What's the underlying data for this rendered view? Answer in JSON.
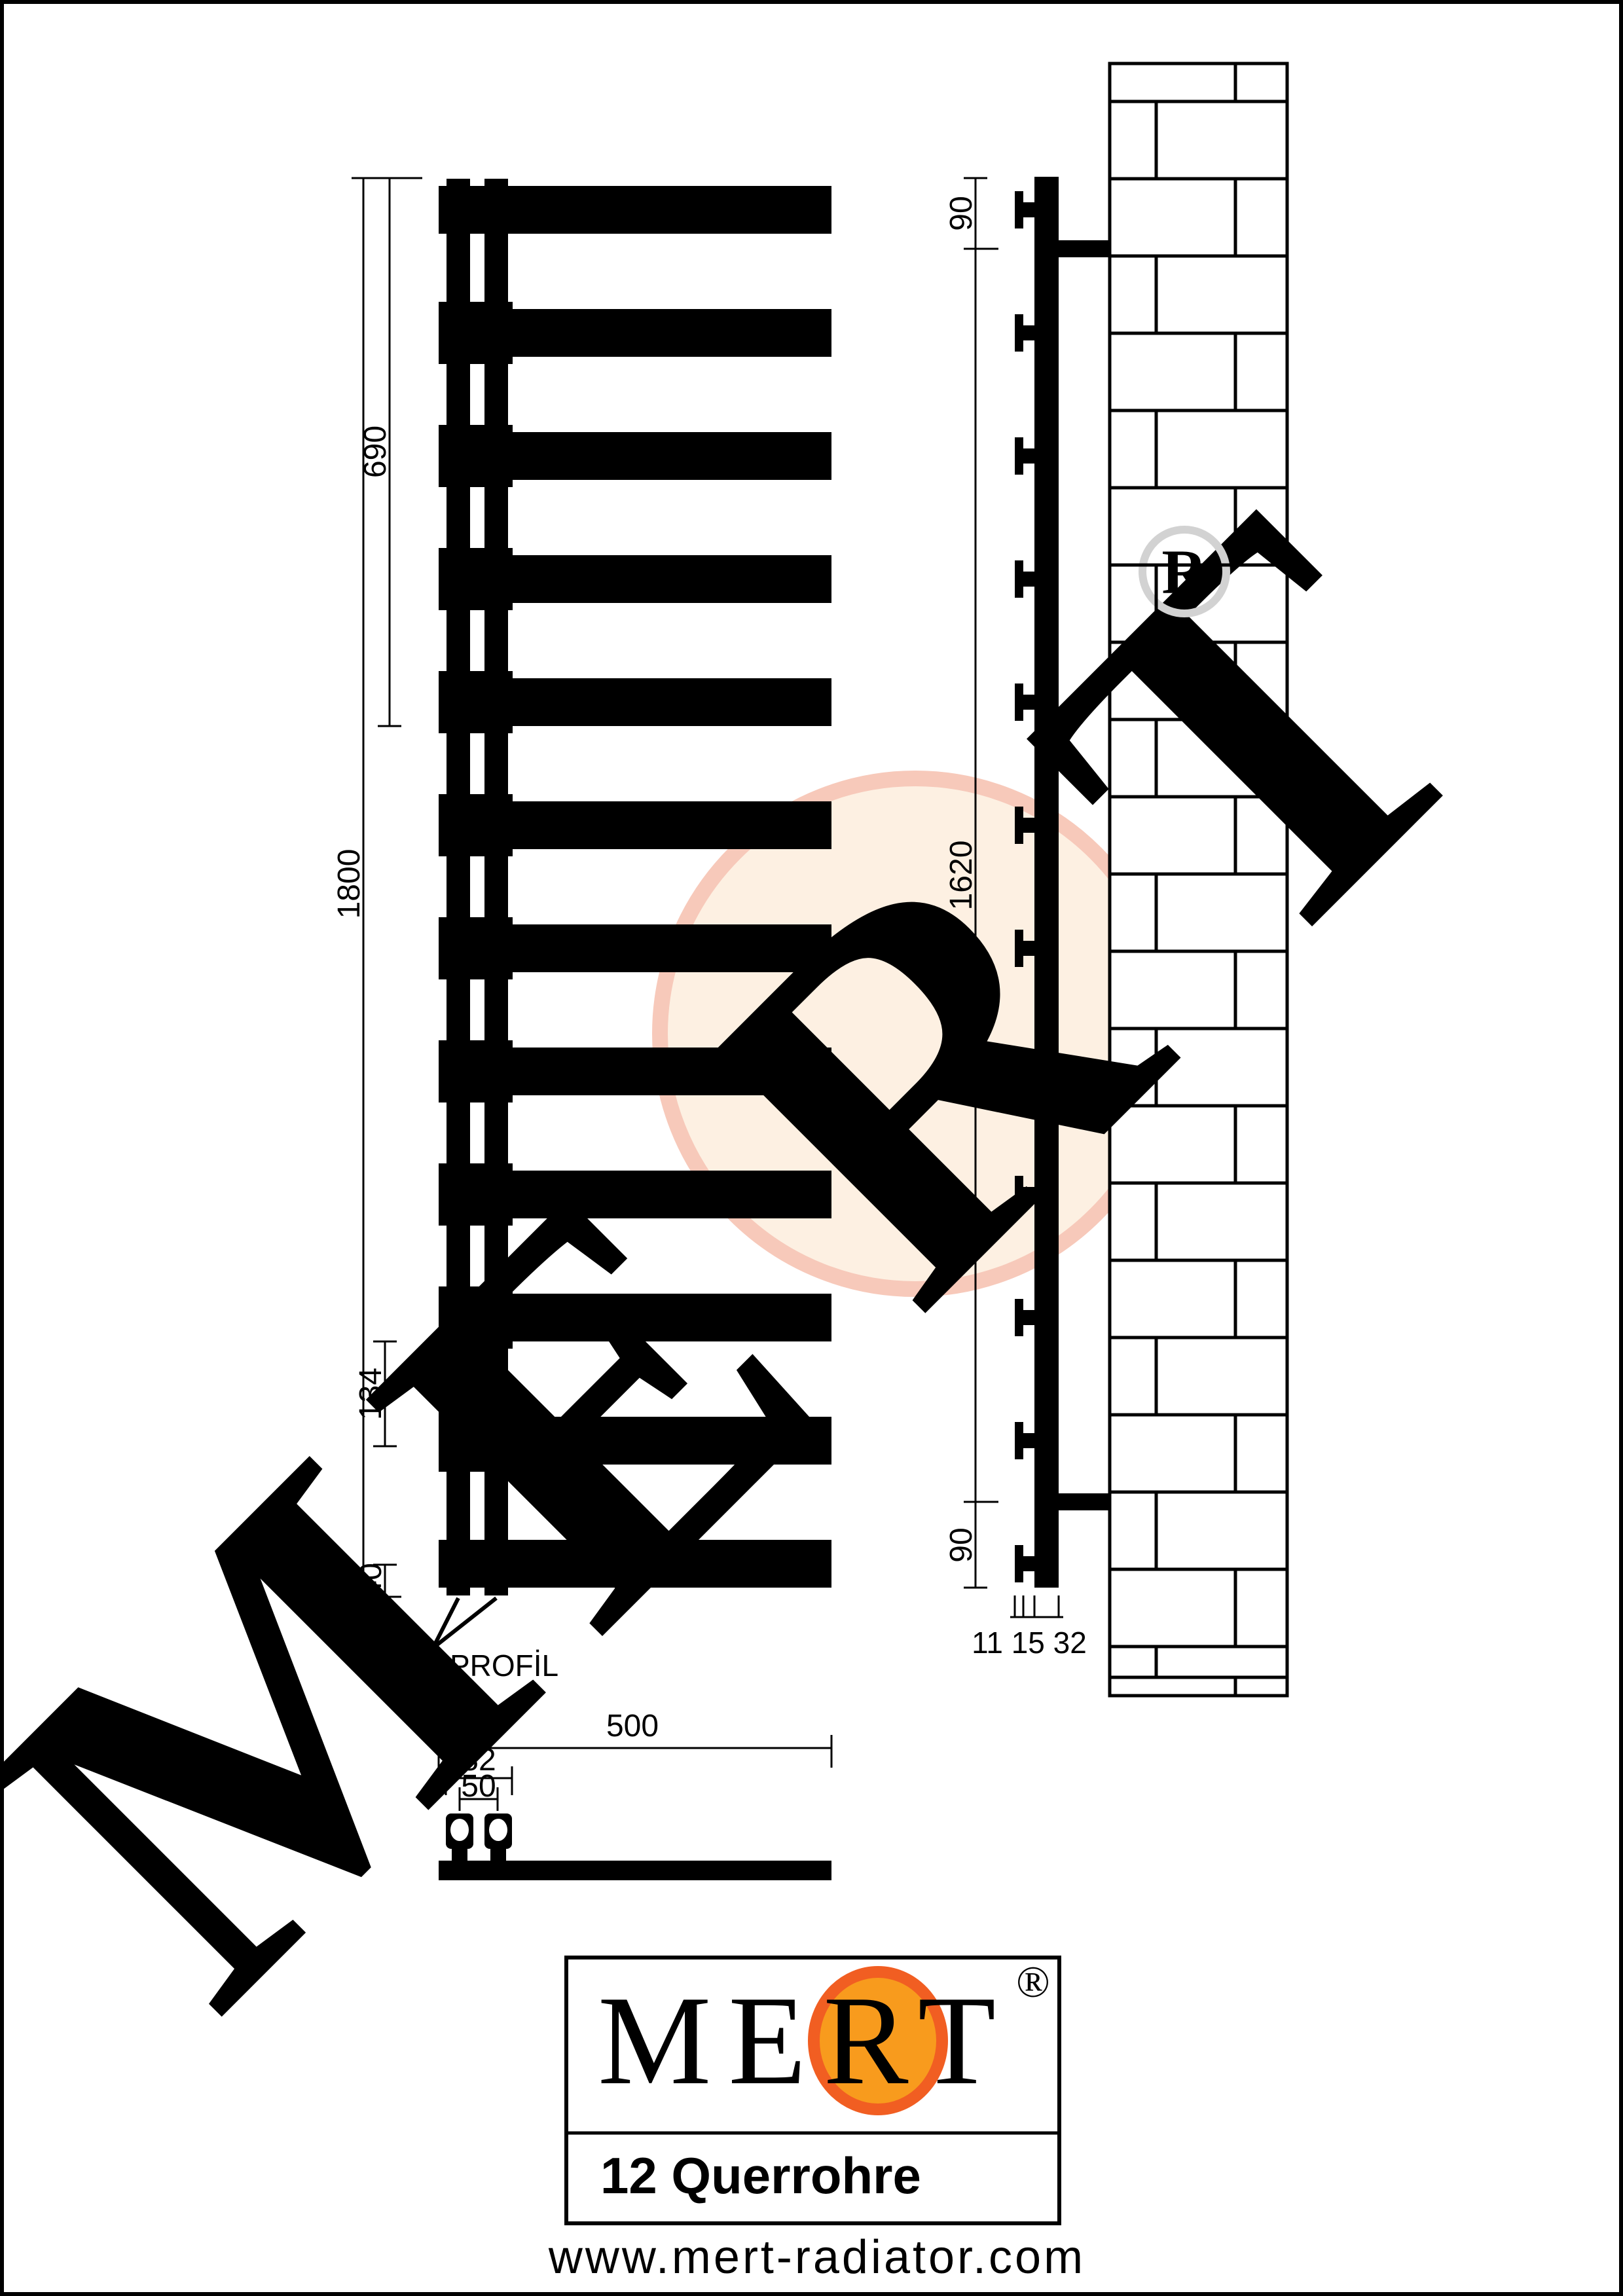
{
  "watermark": {
    "letters": [
      "M",
      "E",
      "R",
      "T"
    ],
    "registered_letter": "R",
    "letter_color": "#d2d2d2",
    "circle_fill": "#fdf0e2",
    "circle_rim": "#f7c9ba"
  },
  "front_view": {
    "tube_count": 12,
    "dim_total_height": "1800",
    "dim_upper_section": "690",
    "dim_tube_spacing": "134",
    "dim_bottom": "40",
    "profile_label": "32x32 PROFİL"
  },
  "side_view": {
    "dim_top_offset": "90",
    "dim_bracket_span": "1620",
    "dim_bottom_offset": "90",
    "dim_depth": "11 15 32"
  },
  "plan_view": {
    "dim_width": "500",
    "dim_profile_outer": "82",
    "dim_profile_centers": "50"
  },
  "logo": {
    "brand": "MERT",
    "registered": "®",
    "product": "12 Querrohre",
    "website": "www.mert-radiator.com",
    "orange_fill": "#F89B1D",
    "orange_rim": "#F15E22"
  }
}
